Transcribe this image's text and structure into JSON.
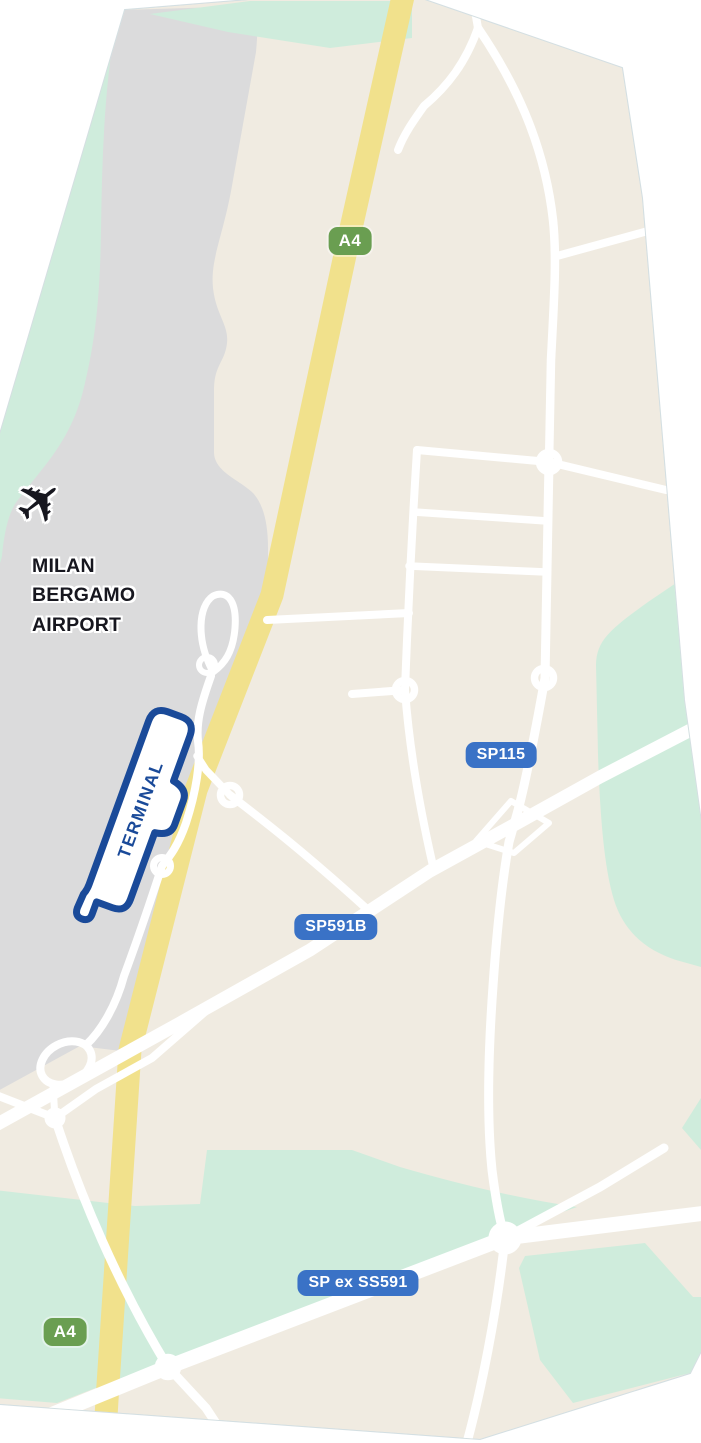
{
  "map": {
    "airport": {
      "icon": "✈",
      "name_lines": [
        "MILAN",
        "BERGAMO",
        "AIRPORT"
      ],
      "terminal_label": "TERMINAL"
    },
    "badges": {
      "a4": "A4",
      "sp115": "SP115",
      "sp591b": "SP591B",
      "sp_ex_ss591": "SP ex SS591"
    },
    "colors": {
      "land": "#F0EBE1",
      "airport_grounds": "#DBDBDC",
      "greenery": "#CFECDC",
      "highway": "#F1E18C",
      "road": "#FFFFFF",
      "badge_green": "#6A9E51",
      "badge_blue": "#3A72C6",
      "terminal_blue": "#1A4A99",
      "label_text": "#17171F",
      "map_edge": "#C9D7DB"
    }
  }
}
